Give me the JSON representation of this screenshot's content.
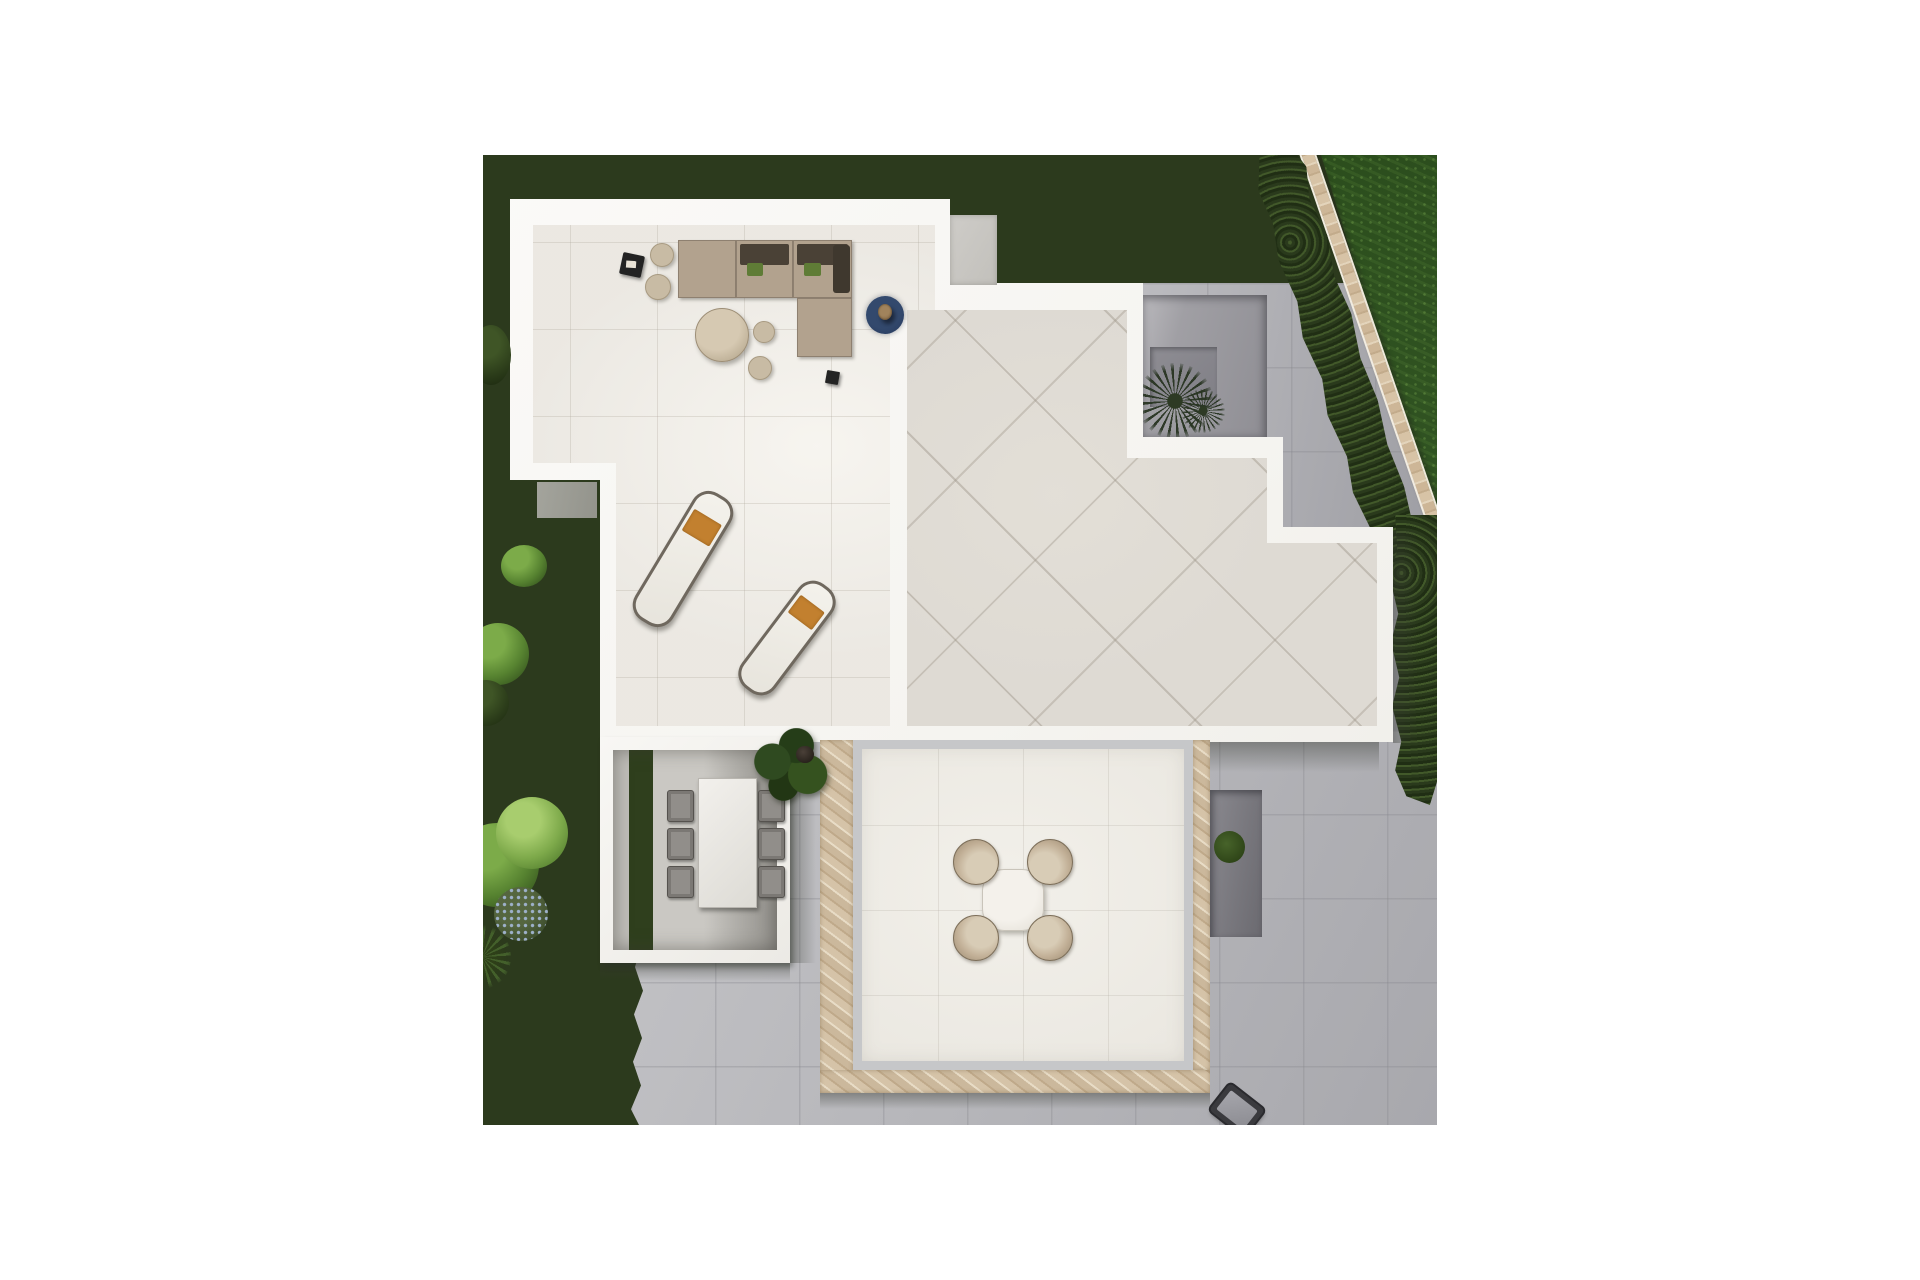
{
  "scene": {
    "description": "Top-down 3D architectural render of a modern villa flat roof terrace and garden: lounge sofa set, two sun loungers, covered dining pergola, lower patio with round table and four chairs, sunken courtyard with palm, dark lawn with shrubs on the left, bright lawn with diagonal stone wall and hedge at top right, gray paved areas at right and bottom.",
    "left": 483,
    "top": 155,
    "width": 954,
    "height": 970,
    "palette": {
      "page-bg": "#ffffff",
      "lawn-dark": "#283518",
      "lawn-bright": "#2d4f1e",
      "hedge-green": "#2c3d1e",
      "stone-tan": "#d7c3a6",
      "wall-white": "#f7f6f3",
      "terrace-floor": "#ebe8e2",
      "roof-tile": "#dedad3",
      "paving-gray": "#b5b5b9",
      "courtyard-gray": "#9b9aa0",
      "sofa-tan": "#b2a28e",
      "cushion-brown": "#4a4136",
      "pillow-green": "#5f7c36",
      "rug-navy": "#2c4161",
      "towel-orange": "#c2802f",
      "chair-taupe": "#c2b097",
      "stone-mosaic": "#d8c8b0"
    },
    "layout": {
      "lawn-base": {
        "x": 0,
        "y": 0,
        "w": 954,
        "h": 970
      },
      "paving-area-right": {
        "x": 640,
        "y": 128,
        "w": 314,
        "h": 460
      },
      "paving-area-bottom": {
        "x": 148,
        "y": 575,
        "w": 806,
        "h": 395
      },
      "bright-lawn": {
        "x": 838,
        "y": 0,
        "w": 116,
        "h": 380
      },
      "stone-boundary-wall": {
        "x": 881,
        "y": -14,
        "w": 16,
        "h": 400,
        "r": -19
      },
      "boundary-hedge": {
        "x": 830,
        "y": -12,
        "w": 54,
        "h": 452,
        "r": -17
      },
      "edge-hedge": {
        "x": 903,
        "y": 360,
        "w": 51,
        "h": 290
      },
      "sunken-courtyard": {
        "x": 660,
        "y": 140,
        "w": 124,
        "h": 142
      },
      "courtyard-floor": {
        "x": 7,
        "y": 52,
        "w": 67,
        "h": 60
      },
      "palm-large": {
        "x": -6,
        "y": 68,
        "w": 76,
        "h": 76
      },
      "palm-small": {
        "x": 38,
        "y": 94,
        "w": 44,
        "h": 44
      },
      "shadow-roof-right": {
        "x": 910,
        "y": 376,
        "w": 26,
        "h": 212
      },
      "shadow-main-bottom": {
        "x": 404,
        "y": 587,
        "w": 492,
        "h": 30
      },
      "main-structure": {
        "x": 0,
        "y": 0,
        "w": 954,
        "h": 970
      },
      "terrace-floor": {
        "x": 0,
        "y": 0,
        "w": 954,
        "h": 970
      },
      "roof-floor": {
        "x": 0,
        "y": 0,
        "w": 954,
        "h": 970
      },
      "roof-step-gray": {
        "x": 467,
        "y": 60,
        "w": 47,
        "h": 70
      },
      "notch-floor-gray": {
        "x": 54,
        "y": 327,
        "w": 60,
        "h": 36
      },
      "sofa-chaise": {
        "x": 195,
        "y": 85,
        "w": 58,
        "h": 58
      },
      "sofa-middle": {
        "x": 253,
        "y": 85,
        "w": 57,
        "h": 58
      },
      "sofa-corner": {
        "x": 310,
        "y": 85,
        "w": 59,
        "h": 58
      },
      "sofa-ottoman": {
        "x": 314,
        "y": 143,
        "w": 55,
        "h": 59
      },
      "pouf-top": {
        "x": 167,
        "y": 88,
        "w": 24,
        "h": 24
      },
      "pouf-lower": {
        "x": 162,
        "y": 119,
        "w": 26,
        "h": 26
      },
      "tray-table": {
        "x": 138,
        "y": 99,
        "w": 22,
        "h": 22,
        "r": 12
      },
      "coffee-table": {
        "x": 212,
        "y": 153,
        "w": 54,
        "h": 54
      },
      "pouf-small-a": {
        "x": 270,
        "y": 166,
        "w": 22,
        "h": 22
      },
      "pouf-small-b": {
        "x": 265,
        "y": 201,
        "w": 24,
        "h": 24
      },
      "navy-rug": {
        "x": 383,
        "y": 141,
        "w": 38,
        "h": 38
      },
      "wood-lamp": {
        "x": 395,
        "y": 149,
        "w": 14,
        "h": 16
      },
      "black-cube-table": {
        "x": 343,
        "y": 216,
        "w": 13,
        "h": 13,
        "r": 10
      },
      "sun-lounger-1": {
        "x": 178,
        "y": 330,
        "w": 44,
        "h": 148,
        "r": 31
      },
      "sun-lounger-2": {
        "x": 283,
        "y": 418,
        "w": 42,
        "h": 130,
        "r": 37
      },
      "dining-pergola": {
        "x": 117,
        "y": 582,
        "w": 190,
        "h": 226
      },
      "pergola-interior": {
        "x": 13,
        "y": 13,
        "w": 164,
        "h": 200
      },
      "dining-table": {
        "x": 98,
        "y": 41,
        "w": 59,
        "h": 130
      },
      "dining-chair-l1": {
        "x": 67,
        "y": 53,
        "w": 27,
        "h": 32
      },
      "dining-chair-l2": {
        "x": 67,
        "y": 91,
        "w": 27,
        "h": 32
      },
      "dining-chair-l3": {
        "x": 67,
        "y": 129,
        "w": 27,
        "h": 32
      },
      "dining-chair-r1": {
        "x": 158,
        "y": 53,
        "w": 27,
        "h": 32
      },
      "dining-chair-r2": {
        "x": 158,
        "y": 91,
        "w": 27,
        "h": 32
      },
      "dining-chair-r3": {
        "x": 158,
        "y": 129,
        "w": 27,
        "h": 32
      },
      "potted-plant": {
        "x": 267,
        "y": 573,
        "w": 80,
        "h": 80
      },
      "stone-band-left": {
        "x": 337,
        "y": 585,
        "w": 33,
        "h": 353
      },
      "stone-band-bottom": {
        "x": 337,
        "y": 915,
        "w": 390,
        "h": 23
      },
      "stone-band-right": {
        "x": 710,
        "y": 585,
        "w": 17,
        "h": 330
      },
      "patio-floor": {
        "x": 370,
        "y": 585,
        "w": 340,
        "h": 330
      },
      "round-table": {
        "x": 499,
        "y": 714,
        "w": 62,
        "h": 62
      },
      "patio-chair-nw": {
        "x": 470,
        "y": 684,
        "w": 46,
        "h": 46
      },
      "patio-chair-ne": {
        "x": 544,
        "y": 684,
        "w": 46,
        "h": 46
      },
      "patio-chair-sw": {
        "x": 470,
        "y": 760,
        "w": 46,
        "h": 46
      },
      "patio-chair-se": {
        "x": 544,
        "y": 760,
        "w": 46,
        "h": 46
      },
      "lightwell": {
        "x": 727,
        "y": 635,
        "w": 52,
        "h": 147
      },
      "shadow-stone-bottom": {
        "x": 337,
        "y": 938,
        "w": 390,
        "h": 16
      },
      "shadow-pergola-bottom": {
        "x": 117,
        "y": 808,
        "w": 190,
        "h": 18
      },
      "shadow-pergola-right": {
        "x": 307,
        "y": 600,
        "w": 26,
        "h": 208
      },
      "grill-unit": {
        "x": 732,
        "y": 938,
        "w": 44,
        "h": 34,
        "r": 38
      },
      "bush-top": {
        "x": -12,
        "y": 170,
        "w": 40,
        "h": 60
      },
      "bush-mid": {
        "x": 18,
        "y": 390,
        "w": 46,
        "h": 42
      },
      "tree-round": {
        "x": -16,
        "y": 468,
        "w": 62,
        "h": 62
      },
      "bush-shadowed": {
        "x": -20,
        "y": 525,
        "w": 46,
        "h": 46
      },
      "bush-big-bright": {
        "x": -28,
        "y": 668,
        "w": 84,
        "h": 84
      },
      "bush-light-speckled": {
        "x": 13,
        "y": 642,
        "w": 72,
        "h": 72
      },
      "flower-cluster-blue": {
        "x": 11,
        "y": 732,
        "w": 54,
        "h": 54
      },
      "frond-plant": {
        "x": -30,
        "y": 770,
        "w": 58,
        "h": 64
      }
    }
  }
}
